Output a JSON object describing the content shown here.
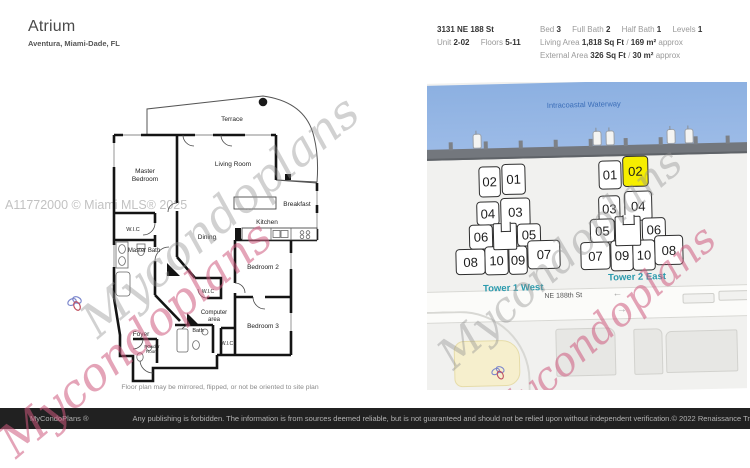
{
  "header": {
    "title": "Atrium",
    "subtitle": "Aventura, Miami-Dade, FL",
    "address": "3131 NE 188 St",
    "unit_label": "Unit",
    "unit_value": "2-02",
    "floors_label": "Floors",
    "floors_value": "5-11",
    "bed_label": "Bed",
    "bed_value": "3",
    "full_bath_label": "Full Bath",
    "full_bath_value": "2",
    "half_bath_label": "Half Bath",
    "half_bath_value": "1",
    "levels_label": "Levels",
    "levels_value": "1",
    "living_area_label": "Living Area",
    "living_area_value": "1,818 Sq Ft",
    "living_area_sep": "/",
    "living_area_metric": "169 m²",
    "living_area_approx": "approx",
    "external_area_label": "External Area",
    "external_area_value": "326 Sq Ft",
    "external_area_sep": "/",
    "external_area_metric": "30 m²",
    "external_area_approx": "approx"
  },
  "floorplan": {
    "rooms": {
      "terrace": "Terrace",
      "master_bedroom_1": "Master",
      "master_bedroom_2": "Bedroom",
      "living_room": "Living Room",
      "breakfast": "Breakfast",
      "kitchen": "Kitchen",
      "dining": "Dining",
      "wic_master": "W.I.C",
      "master_bath": "Master Bath",
      "bedroom2": "Bedroom 2",
      "wic_center": "W.I.C",
      "computer_1": "Computer",
      "computer_2": "area",
      "bedroom3": "Bedroom 3",
      "bath": "Bath",
      "wic_bottom": "W.I.C",
      "foyer": "Foyer",
      "powder_1": "Powder",
      "powder_2": "Room"
    },
    "caption": "Floor plan may be mirrored, flipped, or not be oriented to site plan",
    "mls_watermark": "A11772000 © Miami MLS® 2025",
    "watermark_script": "Mycondoplans"
  },
  "sitemap": {
    "waterway_label": "Intracoastal Waterway",
    "street_label": "NE 188th St",
    "towers": [
      {
        "name": "Tower 1 West",
        "rows": [
          [
            "02",
            "01"
          ],
          [
            "04",
            "03"
          ],
          [
            "06",
            "05"
          ],
          [
            "08",
            "10",
            "09",
            "07"
          ]
        ],
        "highlighted": ""
      },
      {
        "name": "Tower 2 East",
        "rows": [
          [
            "01",
            "02"
          ],
          [
            "03",
            "04"
          ],
          [
            "05",
            "06"
          ],
          [
            "07",
            "09",
            "10",
            "08"
          ]
        ],
        "highlighted": "02"
      }
    ],
    "highlight_color": "#f6ee00",
    "compass": {
      "n": "N",
      "s": "S",
      "e": "E",
      "w": "W"
    }
  },
  "footer": {
    "brand": "MyCondoPlans ®",
    "disclaimer": "Any publishing is forbidden. The information is from sources deemed reliable, but is not guaranteed and should not be relied upon without independent verification.",
    "copyright": "© 2022 Renaissance Trading Corp  All Rights Reserved"
  }
}
